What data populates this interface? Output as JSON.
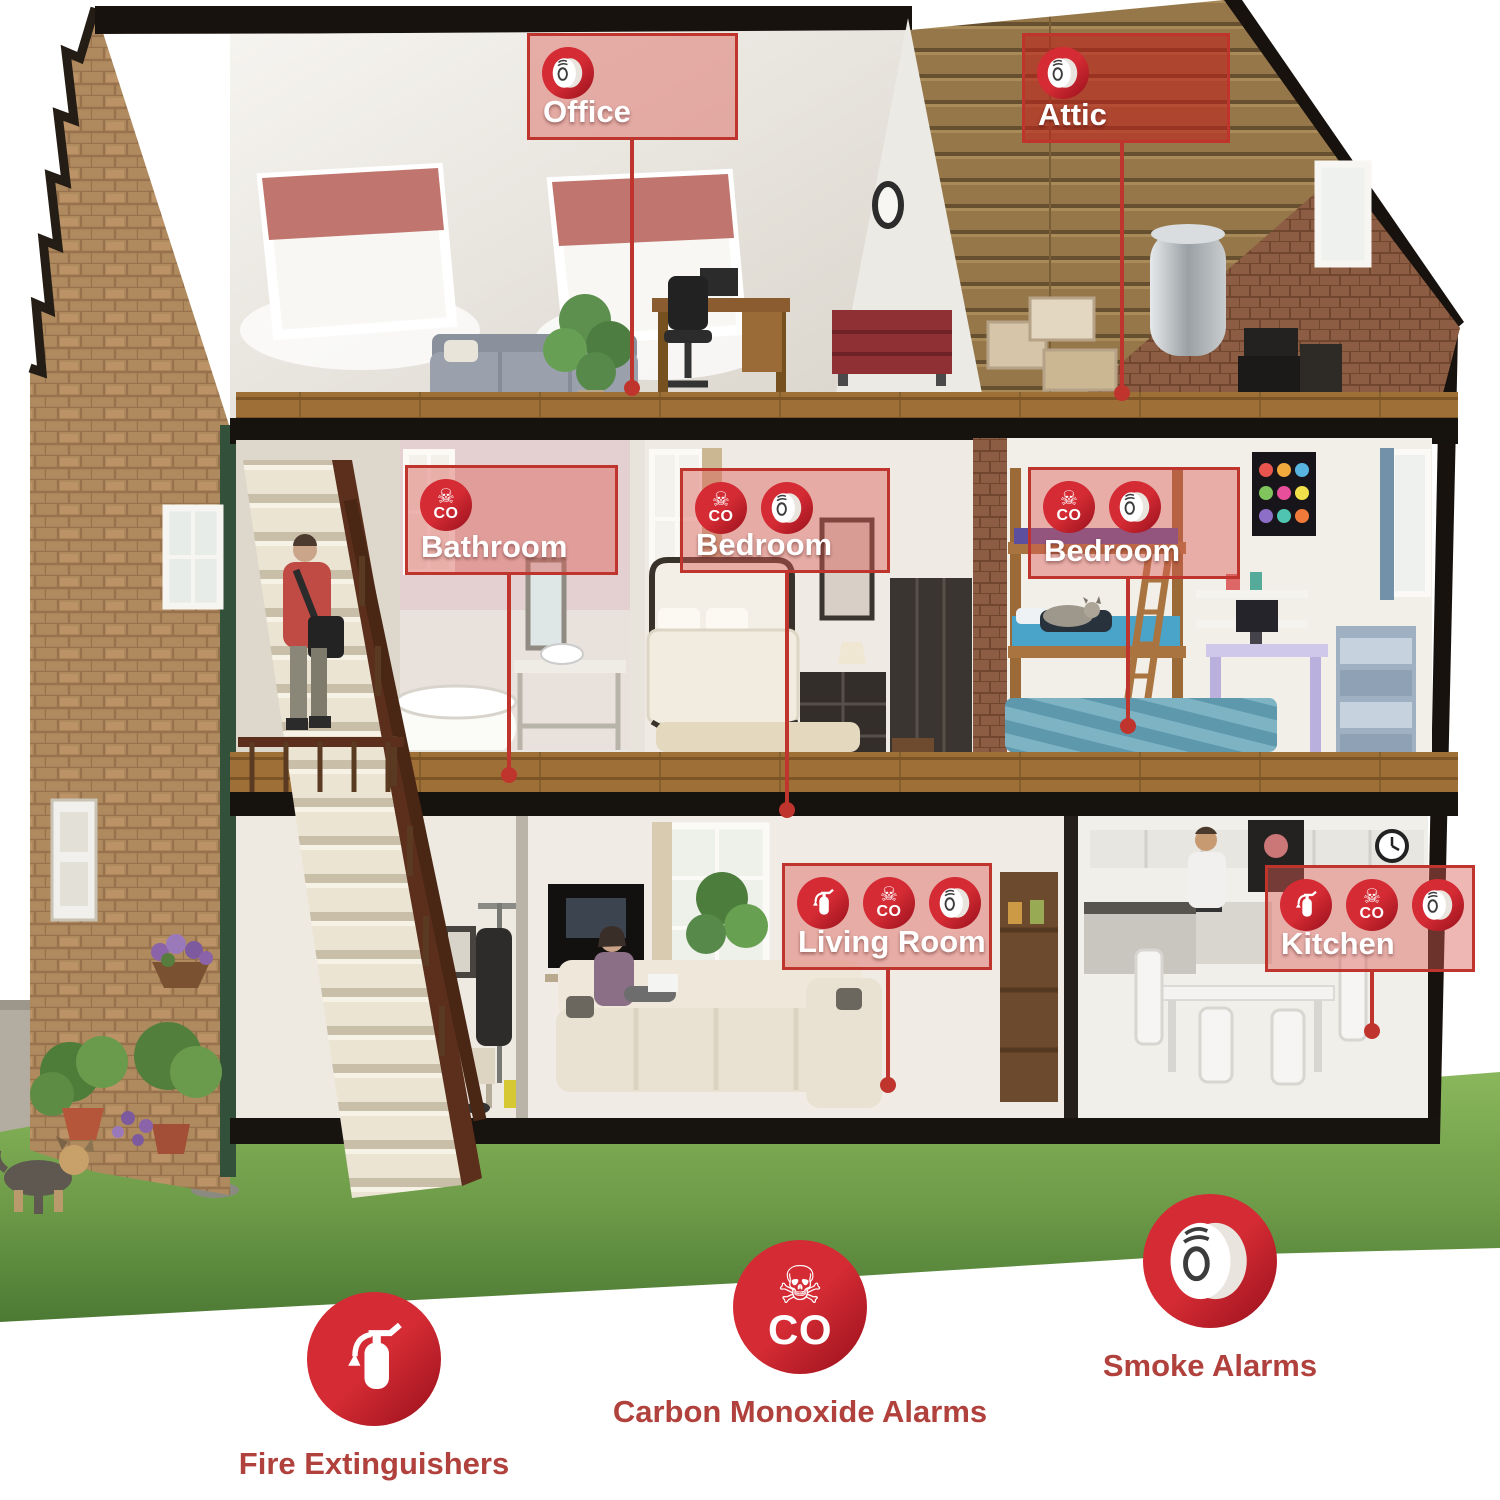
{
  "labels": {
    "office": {
      "name": "Office"
    },
    "attic": {
      "name": "Attic"
    },
    "bathroom": {
      "name": "Bathroom"
    },
    "bedroom1": {
      "name": "Bedroom"
    },
    "bedroom2": {
      "name": "Bedroom"
    },
    "living": {
      "name": "Living Room"
    },
    "kitchen": {
      "name": "Kitchen"
    }
  },
  "icons": {
    "skull_char": "☠",
    "co_text": "CO"
  },
  "legend": {
    "items": [
      {
        "id": "fire-extinguishers",
        "label": "Fire Extinguishers"
      },
      {
        "id": "carbon-monoxide-alarms",
        "label": "Carbon Monoxide Alarms"
      },
      {
        "id": "smoke-alarms",
        "label": "Smoke Alarms"
      }
    ]
  },
  "colors": {
    "accent": "#c0342e",
    "badge_red": "#c9242e",
    "legend_text": "#b0413c",
    "lawn": "#6c9a47"
  }
}
